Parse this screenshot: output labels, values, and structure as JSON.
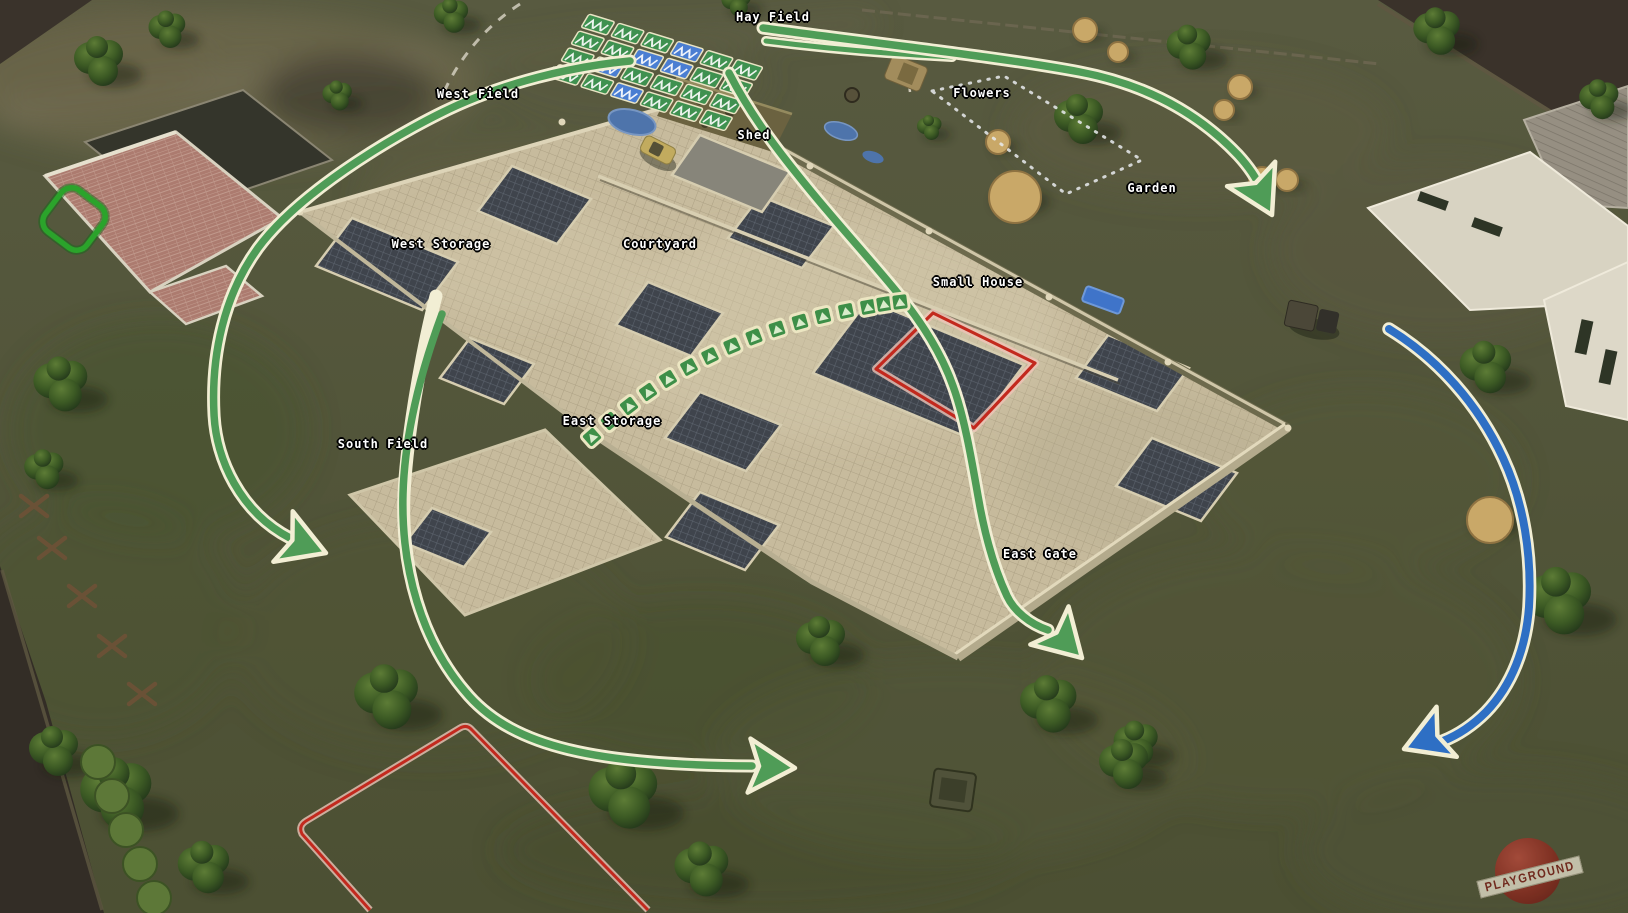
{
  "watermark": {
    "text": "PLAYGROUND"
  },
  "map_labels": [
    {
      "id": "hay-field",
      "text": "Hay Field",
      "x": 773,
      "y": 17
    },
    {
      "id": "west-field",
      "text": "West Field",
      "x": 478,
      "y": 94
    },
    {
      "id": "flowers",
      "text": "Flowers",
      "x": 982,
      "y": 93
    },
    {
      "id": "shed",
      "text": "Shed",
      "x": 754,
      "y": 135
    },
    {
      "id": "garden",
      "text": "Garden",
      "x": 1152,
      "y": 188
    },
    {
      "id": "west-storage",
      "text": "West Storage",
      "x": 441,
      "y": 244
    },
    {
      "id": "courtyard",
      "text": "Courtyard",
      "x": 660,
      "y": 244
    },
    {
      "id": "small-house",
      "text": "Small House",
      "x": 978,
      "y": 282
    },
    {
      "id": "east-storage",
      "text": "East Storage",
      "x": 612,
      "y": 421
    },
    {
      "id": "south-field",
      "text": "South Field",
      "x": 383,
      "y": 444
    },
    {
      "id": "east-gate",
      "text": "East Gate",
      "x": 1040,
      "y": 554
    }
  ],
  "annotations": {
    "colors": {
      "movement_arrow_green": "#4f9c57",
      "movement_arrow_blue": "#2e6fc4",
      "arrow_outline_cream": "#f2eed4",
      "zone_red": "#c3291e",
      "zone_green": "#2ba32b",
      "garden_dotted_white": "#e9ebee",
      "waypoint_green": "#3e8f48"
    },
    "arrows": [
      {
        "id": "west-flank-arrow",
        "color": "green"
      },
      {
        "id": "south-loop-arrow",
        "color": "green"
      },
      {
        "id": "courtyard-assault-arrow",
        "color": "green"
      },
      {
        "id": "hayfield-to-garden-arrow",
        "color": "green"
      },
      {
        "id": "east-flank-arrow",
        "color": "blue"
      }
    ],
    "zones": [
      {
        "id": "small-house-objective",
        "style": "red-outline"
      },
      {
        "id": "south-field-zone",
        "style": "red-outline"
      },
      {
        "id": "west-building-marker",
        "style": "green-outline"
      },
      {
        "id": "garden-area-outline",
        "style": "white-dotted"
      }
    ],
    "waypoints": [
      [
        592,
        437
      ],
      [
        610,
        421
      ],
      [
        629,
        406
      ],
      [
        648,
        392
      ],
      [
        668,
        379
      ],
      [
        689,
        367
      ],
      [
        710,
        356
      ],
      [
        732,
        346
      ],
      [
        754,
        337
      ],
      [
        777,
        329
      ],
      [
        800,
        322
      ],
      [
        823,
        316
      ],
      [
        846,
        311
      ],
      [
        868,
        307
      ],
      [
        884,
        304
      ],
      [
        900,
        302
      ]
    ]
  }
}
